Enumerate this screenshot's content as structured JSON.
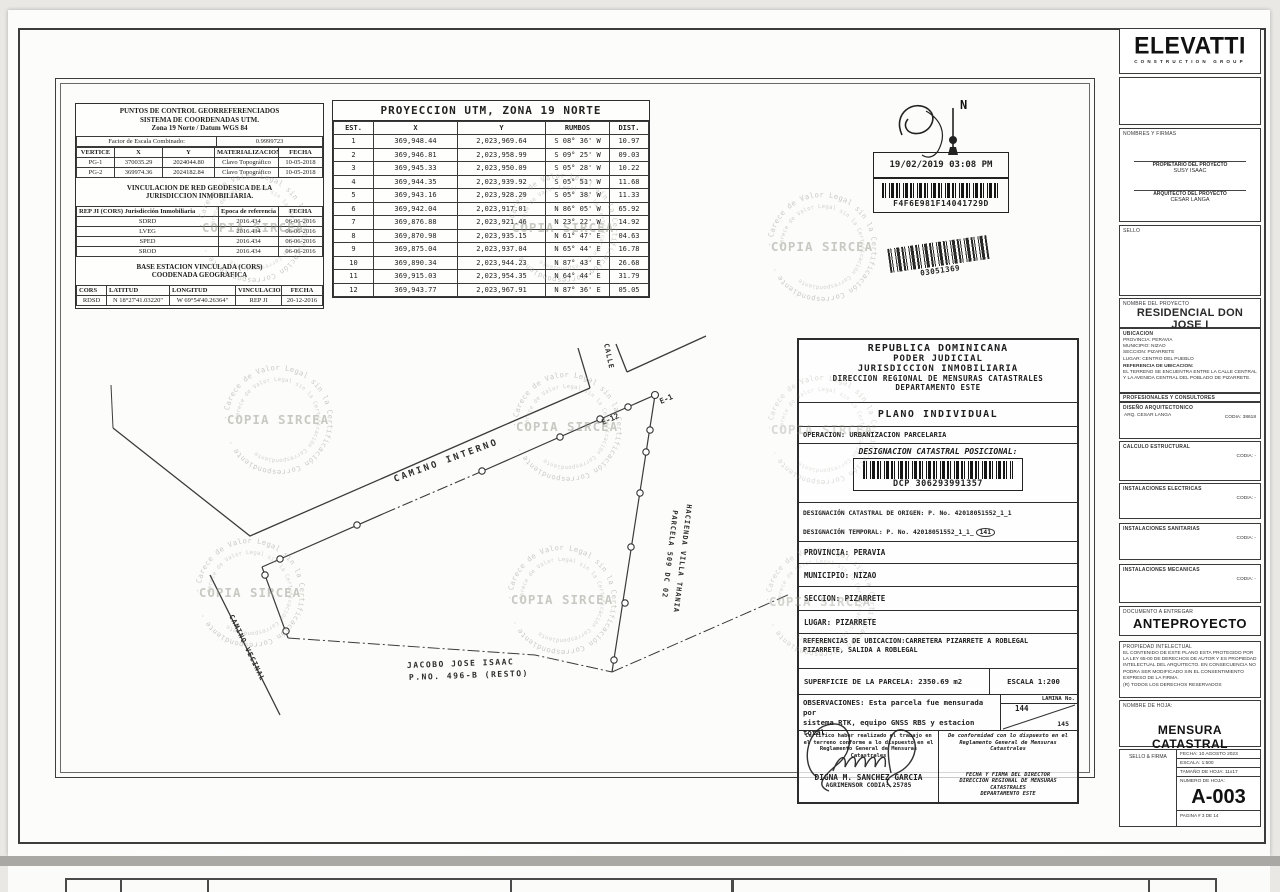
{
  "watermark": {
    "center": "COPIA SIRCEA",
    "ring": "Carece de Valor Legal sin la Certificación Correspondiente",
    "ring2": "· Carece de Valor Legal sin la Certificación Correspondiente ·"
  },
  "control": {
    "title1": "PUNTOS DE CONTROL GEORREFERENCIADOS",
    "title2": "SISTEMA DE COORDENADAS UTM.",
    "title3": "Zona 19 Norte / Datum WGS 84",
    "scale_label": "Factor de Escala Combinado:",
    "scale_value": "0.9999723",
    "h1": "VERTICE",
    "h2": "X",
    "h3": "Y",
    "h4": "MATERIALIZACION",
    "h5": "FECHA",
    "rows": [
      [
        "PG-1",
        "370035.29",
        "2024044.80",
        "Clavo Topográfico",
        "10-05-2018"
      ],
      [
        "PG-2",
        "369974.36",
        "2024182.84",
        "Clavo Topográfico",
        "10-05-2018"
      ]
    ],
    "vinc_title1": "VINCULACION DE RED GEODESICA DE LA",
    "vinc_title2": "JURISDICCION INMOBILIARIA.",
    "vh1": "REP JI (CORS) Jurisdicción Inmobiliaria",
    "vh2": "Epoca de referencia",
    "vh3": "FECHA",
    "vinc_rows": [
      [
        "SDRD",
        "2016.434",
        "06-06-2016"
      ],
      [
        "LVEG",
        "2016.434",
        "06-06-2016"
      ],
      [
        "SPED",
        "2016.434",
        "06-06-2016"
      ],
      [
        "SROD",
        "2016.434",
        "06-06-2016"
      ]
    ],
    "base_title1": "BASE ESTACION VINCULADA (CORS)",
    "base_title2": "COODENADA GEOGRAFICA",
    "bh1": "CORS",
    "bh2": "LATITUD",
    "bh3": "LONGITUD",
    "bh4": "VINCULACION",
    "bh5": "FECHA",
    "base_rows": [
      [
        "RDSD",
        "N 18°27'41.03220\"",
        "W 69°54'40.26364\"",
        "REP JI",
        "20-12-2016"
      ]
    ]
  },
  "utm": {
    "title": "PROYECCION UTM, ZONA 19 NORTE",
    "h1": "EST.",
    "h2": "X",
    "h3": "Y",
    "h4": "RUMBOS",
    "h5": "DIST.",
    "rows": [
      [
        "1",
        "369,948.44",
        "2,023,969.64",
        "S 08° 36' W",
        "10.97"
      ],
      [
        "2",
        "369,946.81",
        "2,023,958.99",
        "S 09° 25' W",
        "09.03"
      ],
      [
        "3",
        "369,945.33",
        "2,023,950.09",
        "S 05° 28' W",
        "10.22"
      ],
      [
        "4",
        "369,944.35",
        "2,023,939.92",
        "S 05° 51' W",
        "11.68"
      ],
      [
        "5",
        "369,943.16",
        "2,023,928.29",
        "S 05° 38' W",
        "11.33"
      ],
      [
        "6",
        "369,942.04",
        "2,023,917.01",
        "N 86° 05' W",
        "65.92"
      ],
      [
        "7",
        "369,876.88",
        "2,023,921.46",
        "N 23° 22' W",
        "14.92"
      ],
      [
        "8",
        "369,870.98",
        "2,023,935.15",
        "N 61° 47' E",
        "04.63"
      ],
      [
        "9",
        "369,875.04",
        "2,023,937.04",
        "N 65° 44' E",
        "16.78"
      ],
      [
        "10",
        "369,890.34",
        "2,023,944.23",
        "N 87° 43' E",
        "26.68"
      ],
      [
        "11",
        "369,915.03",
        "2,023,954.35",
        "N 64° 44' E",
        "31.79"
      ],
      [
        "12",
        "369,943.77",
        "2,023,967.91",
        "N 87° 36' E",
        "05.05"
      ]
    ]
  },
  "stamps": {
    "north": "N",
    "datetime": "19/02/2019 03:08 PM",
    "code1": "F4F6E981F14041729D",
    "code2": "03051369"
  },
  "plot": {
    "camino_interno": "CAMINO INTERNO",
    "camino_vecinal": "CAMINO VECINAL",
    "calle": "CALLE",
    "e1": "E-1",
    "e12": "E-12",
    "parcela": "PARCELA 509 DC 02",
    "hacienda": "HACIENDA VILLA THANIA",
    "owner_line1": "JACOBO JOSE ISAAC",
    "owner_line2": "P.NO. 496-B (RESTO)"
  },
  "judicial": {
    "h1": "REPUBLICA DOMINICANA",
    "h2": "PODER JUDICIAL",
    "h3": "JURISDICCION INMOBILIARIA",
    "h4": "DIRECCION REGIONAL DE MENSURAS CATASTRALES",
    "h5": "DEPARTAMENTO ESTE",
    "plano": "PLANO INDIVIDUAL",
    "operacion": "OPERACION: URBANIZACION PARCELARIA",
    "dcp_label": "DESIGNACION CATASTRAL POSICIONAL:",
    "dcp_code": "DCP 306293991357",
    "origen": "DESIGNACIÓN CATASTRAL DE ORIGEN: P. No. 42018051552_1_1",
    "temporal_prefix": "DESIGNACIÓN TEMPORAL: P. No. 42018051552_1_1",
    "temporal_circled": "141",
    "provincia": "PROVINCIA: PERAVIA",
    "municipio": "MUNICIPIO: NIZAO",
    "seccion": "SECCION: PIZARRETE",
    "lugar": "LUGAR: PIZARRETE",
    "ref1": "REFERENCIAS DE UBICACION:CARRETERA PIZARRETE A ROBLEGAL",
    "ref2": "PIZARRETE, SALIDA A ROBLEGAL",
    "superficie": "SUPERFICIE DE LA PARCELA: 2350.69 m2",
    "escala": "ESCALA 1:200",
    "lamina_label": "LAMINA No.",
    "lamina_a": "144",
    "lamina_b": "145",
    "obs1": "OBSERVACIONES: Esta parcela fue mensurada por",
    "obs2": "sistema RTK, equipo GNSS RBS y estacion total",
    "cert": [
      "Certifico haber realizado el trabajo en",
      "el terreno conforme a lo dispuesto en el",
      "Reglamento General de Mensuras",
      "Catastrales"
    ],
    "agrimensor": "DIGNA M. SANCHEZ GARCIA",
    "agr_codia": "AGRIMENSOR CODIA: 25785",
    "conf": [
      "De conformidad con lo dispuesto en el",
      "Reglamento General de Mensuras",
      "Catastrales"
    ],
    "dir": [
      "FECHA Y FIRMA DEL DIRECTOR",
      "DIRECCION REGIONAL DE MENSURAS",
      "CATASTRALES",
      "DEPARTAMENTO ESTE"
    ]
  },
  "titleblock": {
    "logo": "ELEVATTI",
    "logo_sub": "CONSTRUCTION GROUP",
    "nombres_firmas": "NOMBRES Y FIRMAS",
    "prop_label": "PROPIETARIO DEL PROYECTO",
    "prop_name": "SUSY ISAAC",
    "arq_label": "ARQUITECTO DEL PROYECTO",
    "arq_name": "CESAR LANGA",
    "sello": "SELLO",
    "proyecto_label": "NOMBRE DEL PROYECTO",
    "proyecto": "RESIDENCIAL DON JOSE I",
    "ubicacion_label": "UBICACION",
    "ub_lines": [
      "PROVINCIA: PERAVIA",
      "MUNICIPIO: NIZAO",
      "SECCION: PIZARRETE",
      "LUGAR: CENTRO DEL PUEBLO"
    ],
    "ref_label": "REFERENCIA DE UBICACION:",
    "ref_text": "EL TERRENO SE ENCUENTRA ENTRE LA CALLE CENTRAL Y LA AVENIDA CENTRAL DEL POBLADO DE PIZARRETE.",
    "profesionales": "PROFESIONALES Y CONSULTORES",
    "diseno_label": "DISEÑO ARQUITECTONICO",
    "diseno_name": "ARQ. CESAR LANGA",
    "diseno_codia": "CODIA: 38618",
    "calculo_label": "CALCULO ESTRUCTURAL",
    "calculo_codia": "CODIA: -",
    "elec_label": "INSTALACIONES ELECTRICAS",
    "elec_codia": "CODIA: -",
    "sani_label": "INSTALACIONES SANITARIAS",
    "sani_codia": "CODIA: -",
    "meca_label": "INSTALACIONES MECANICAS",
    "meca_codia": "CODIA: -",
    "doc_label": "DOCUMENTO A ENTREGAR",
    "doc_value": "ANTEPROYECTO",
    "prop_int_label": "PROPIEDAD INTELECTUAL",
    "prop_int_text": "EL CONTENIDO DE ESTE PLANO ESTA PROTEGIDO POR LA LEY 65-00 DE DERECHOS DE AUTOR Y ES PROPIEDAD INTELECTUAL DEL ARQUITECTO. EN CONSECUENCIA NO PODRA SER MODIFICADO SIN EL CONSENTIMIENTO EXPRESO DE LA FIRMA.",
    "derechos": "(R) TODOS LOS DERECHOS RESERVADOS",
    "hoja_label": "NOMBRE DE HOJA:",
    "hoja": "MENSURA CATASTRAL",
    "sello_firma": "SELLO & FIRMA",
    "fecha": "FECHA: 10 AGOSTO 2023",
    "escala": "ESCALA: 1:500",
    "tamano": "TAMAÑO DE HOJA: 11x17",
    "numero_label": "NUMERO DE HOJA:",
    "numero": "A-003",
    "pagina": "PAGINA #    3   DE   14"
  }
}
